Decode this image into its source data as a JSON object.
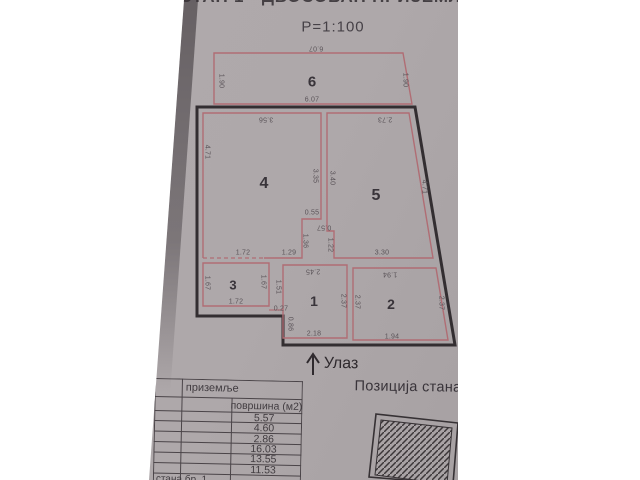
{
  "document": {
    "title_fragment": "СТАН 1 - ДВОСОБАН ПРИЗЕМЉЕ",
    "scale": "Р=1:100"
  },
  "plan": {
    "rooms": {
      "r1": "1",
      "r2": "2",
      "r3": "3",
      "r4": "4",
      "r5": "5",
      "r6": "6"
    },
    "dims": {
      "r6_top": "6.07",
      "r6_bottom": "6.07",
      "r6_left": "1.90",
      "r6_right": "1.90",
      "r4_top": "3.56",
      "r4_left": "4.71",
      "mid_left": "3.35",
      "mid_right": "3.40",
      "r5_top": "2.73",
      "r5_right": "4.71",
      "step_top": "0.55",
      "step_mid": "0.57",
      "drop_left": "1.36",
      "drop_right": "1.22",
      "hall_left": "1.72",
      "hall_mid": "1.29",
      "hall_right": "3.30",
      "r3_left": "1.67",
      "r3_right": "1.67",
      "r3_bottom": "1.72",
      "r1_top": "2.45",
      "r1_left": "1.51",
      "r1_step": "0.27",
      "r1_notch": "0.86",
      "r1_right": "2.37",
      "r1_bottom": "2.18",
      "r2_top": "1.94",
      "r2_left": "2.37",
      "r2_right": "2.37",
      "r2_bottom": "1.94"
    },
    "entrance": "Улаз"
  },
  "legend_table": {
    "floor_header": "приземље",
    "area_header": "површина (м2)",
    "values": [
      "5.57",
      "4.60",
      "2.86",
      "16.03",
      "13.55",
      "11.53"
    ],
    "footer_fragment": "стана бр. 1"
  },
  "position_section": {
    "title": "Позиција стана"
  },
  "colors": {
    "plan_line_red": "#b06d74",
    "wall_black": "#332e31",
    "paper": "#aea8aa"
  }
}
